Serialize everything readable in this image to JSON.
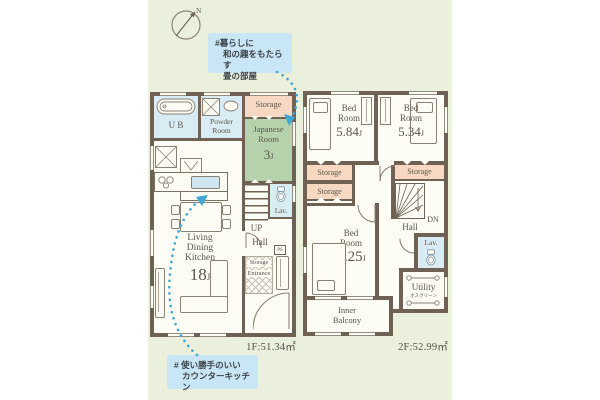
{
  "colors": {
    "panel_bg": "#eaf0dc",
    "wall": "#6f6254",
    "floor": "#fdfcf5",
    "wet_room": "#d9ecf4",
    "storage": "#f7d9c3",
    "tatami": "#b6d2ad",
    "callout_bg": "#c9e6f6",
    "arrow": "#41a8d6",
    "label_text": "#5c564b"
  },
  "compass": {
    "label": "N"
  },
  "callout_top": {
    "line1": "#暮らしに",
    "line2": "和の趣をもたらす",
    "line3": "畳の部屋"
  },
  "callout_bottom": {
    "line1": "# 使い勝手のいい",
    "line2": "カウンターキッチン"
  },
  "floor1": {
    "area": "1F:51.34㎡",
    "ub": "U B",
    "powder1": "Powder",
    "powder2": "Room",
    "storage": "Storage",
    "jp1": "Japanese",
    "jp2": "Room",
    "jp_size": "3",
    "jp_unit": "J",
    "ldk1": "Living",
    "ldk2": "Dining",
    "ldk3": "Kitchen",
    "ldk_size": "18",
    "ldk_unit": "J",
    "lav": "Lav.",
    "up": "UP",
    "hall": "Hall",
    "ps": "PS",
    "storage_small": "Storage",
    "entrance": "Entrance"
  },
  "floor2": {
    "area": "2F:52.99㎡",
    "bed1a": "Bed",
    "bed1b": "Room",
    "bed1_size": "5.84",
    "bed1_unit": "J",
    "bed2a": "Bed",
    "bed2b": "Room",
    "bed2_size": "5.34",
    "bed2_unit": "J",
    "bed3a": "Bed",
    "bed3b": "Room",
    "bed3_size": "8.25",
    "bed3_unit": "J",
    "storage_a": "Storage",
    "storage_b": "Storage",
    "storage_c": "Storage",
    "dn": "DN",
    "hall": "Hall",
    "lav": "Lav.",
    "utility": "Utility",
    "utility_sub": "ホスクリーン",
    "balcony1": "Inner",
    "balcony2": "Balcony"
  }
}
